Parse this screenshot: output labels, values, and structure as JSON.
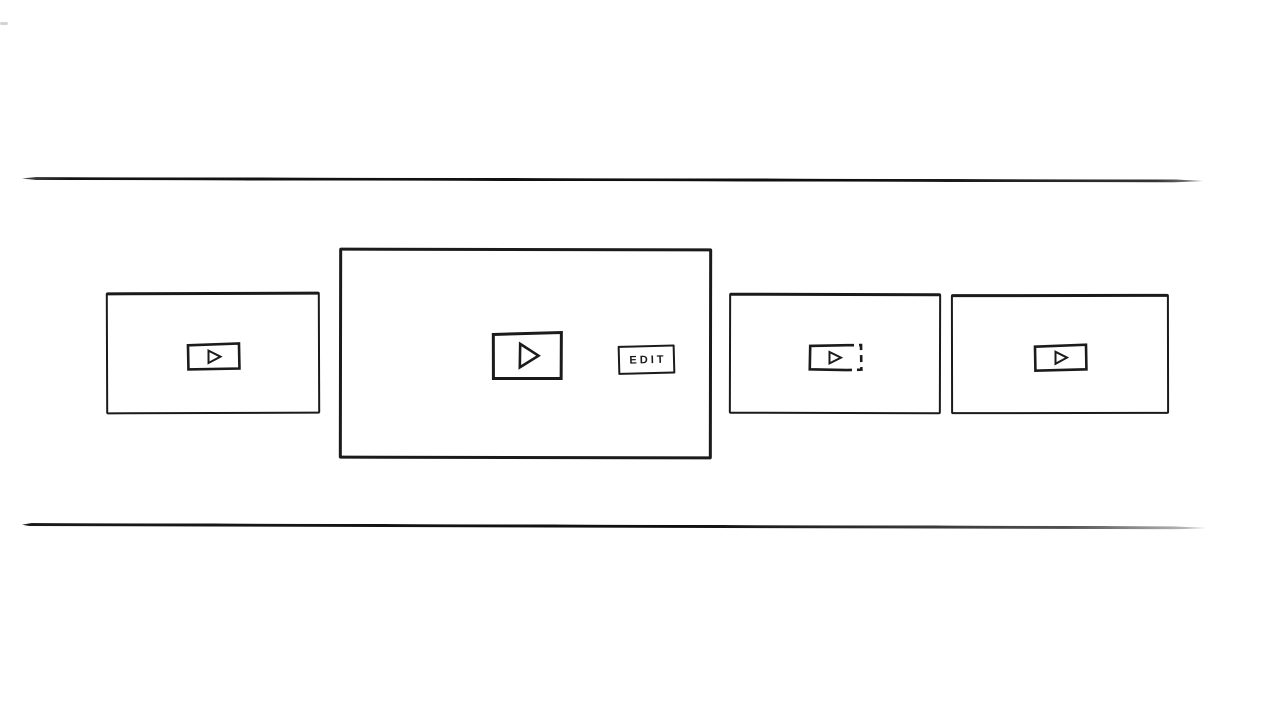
{
  "page": {
    "background_color": "#ffffff",
    "ink_color": "#1b1b1b"
  },
  "timeline": {
    "top_line": "top-boundary-line",
    "bottom_line": "bottom-boundary-line"
  },
  "carousel": {
    "clips": [
      {
        "icon": "play-icon",
        "state": "default"
      },
      {
        "icon": "play-icon",
        "state": "selected-enlarged",
        "edit_button_label": "EDIT"
      },
      {
        "icon": "play-icon-dashed",
        "state": "dashed-placeholder"
      },
      {
        "icon": "play-icon",
        "state": "default"
      }
    ]
  }
}
